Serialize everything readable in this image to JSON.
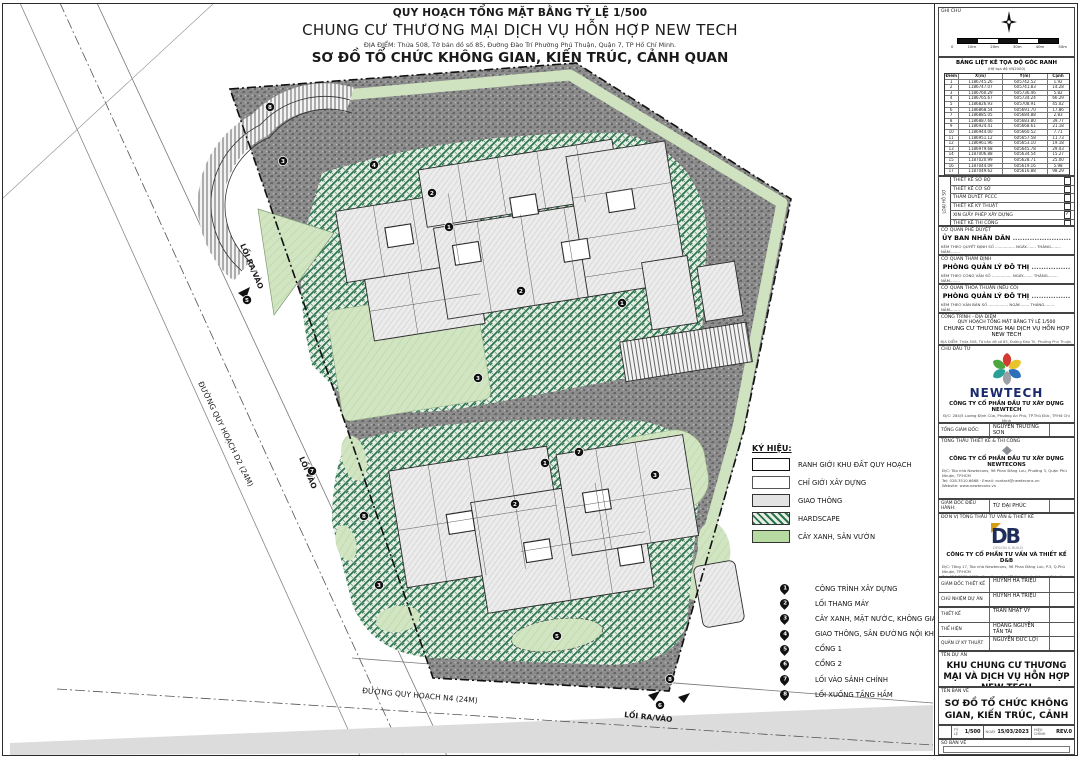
{
  "title_block": {
    "line1": "QUY HOẠCH TỔNG MẶT BẰNG TỶ LỆ 1/500",
    "line2": "CHUNG CƯ THƯƠNG MẠI DỊCH VỤ HỖN HỢP NEW TECH",
    "line3": "ĐỊA ĐIỂM: Thửa 508, Tờ bản đồ số 85, Đường Đào Trí Phường Phú Thuận, Quận 7, TP Hồ Chí Minh.",
    "line4": "SƠ ĐỒ TỔ CHỨC KHÔNG GIAN, KIẾN TRÚC, CẢNH QUAN"
  },
  "plan": {
    "road_d2": "ĐƯỜNG QUY HOẠCH D2 (24M)",
    "road_n4": "ĐƯỜNG QUY HOẠCH N4 (24M)",
    "exit_left": "LỐI RA/VÀO",
    "entry_left": "LỐI VÀO",
    "exit_bottom": "LỐI RA/VÀO",
    "markers": [
      {
        "n": "8",
        "x": 268,
        "y": 104
      },
      {
        "n": "3",
        "x": 281,
        "y": 158
      },
      {
        "n": "4",
        "x": 372,
        "y": 162
      },
      {
        "n": "2",
        "x": 430,
        "y": 190
      },
      {
        "n": "1",
        "x": 447,
        "y": 224
      },
      {
        "n": "2",
        "x": 519,
        "y": 288
      },
      {
        "n": "3",
        "x": 476,
        "y": 375
      },
      {
        "n": "7",
        "x": 577,
        "y": 449
      },
      {
        "n": "1",
        "x": 543,
        "y": 460
      },
      {
        "n": "3",
        "x": 653,
        "y": 472
      },
      {
        "n": "2",
        "x": 513,
        "y": 501
      },
      {
        "n": "8",
        "x": 362,
        "y": 513
      },
      {
        "n": "3",
        "x": 377,
        "y": 582
      },
      {
        "n": "5",
        "x": 555,
        "y": 633
      },
      {
        "n": "8",
        "x": 668,
        "y": 676
      },
      {
        "n": "6",
        "x": 658,
        "y": 702
      },
      {
        "n": "5",
        "x": 245,
        "y": 297
      },
      {
        "n": "7",
        "x": 310,
        "y": 468
      },
      {
        "n": "1",
        "x": 620,
        "y": 300
      }
    ]
  },
  "legend": {
    "title": "KÝ HIỆU:",
    "items": [
      {
        "label": "RANH GIỚI KHU ĐẤT QUY HOẠCH"
      },
      {
        "label": "CHỈ GIỚI XÂY DỰNG"
      },
      {
        "label": "GIAO THÔNG"
      },
      {
        "label": "HARDSCAPE"
      },
      {
        "label": "CÂY XANH, SÂN VƯỜN"
      }
    ]
  },
  "callouts": [
    {
      "num": "1",
      "label": "CÔNG TRÌNH XÂY DỰNG"
    },
    {
      "num": "2",
      "label": "LỐI THANG MÁY"
    },
    {
      "num": "3",
      "label": "CÂY XANH, MẶT NƯỚC, KHÔNG GIAN MỞ"
    },
    {
      "num": "4",
      "label": "GIAO THÔNG, SÂN ĐƯỜNG NỘI KHU"
    },
    {
      "num": "5",
      "label": "CỔNG 1"
    },
    {
      "num": "6",
      "label": "CỔNG 2"
    },
    {
      "num": "7",
      "label": "LỐI VÀO SẢNH CHÍNH"
    },
    {
      "num": "8",
      "label": "LỐI XUỐNG TẦNG HẦM"
    }
  ],
  "right_panel": {
    "ghi_chu": "GHI CHÚ",
    "scale_labels": [
      "0",
      "10m",
      "20m",
      "30m",
      "40m",
      "50m"
    ],
    "coord_table": {
      "title": "BẢNG LIỆT KÊ TỌA ĐỘ GÓC RANH",
      "subtitle": "(Hệ tọa độ VN2000)",
      "col_point": "Điểm",
      "col_x": "X(m)",
      "col_y": "Y(m)",
      "col_edge": "Cạnh",
      "rows": [
        [
          "1",
          "1186745.26",
          "605742.52",
          "1.92"
        ],
        [
          "2",
          "1186747.07",
          "605741.83",
          "14.28"
        ],
        [
          "3",
          "1186760.29",
          "605736.46",
          "5.82"
        ],
        [
          "4",
          "1186765.67",
          "605734.24",
          "66.29"
        ],
        [
          "5",
          "1186826.93",
          "605708.91",
          "45.02"
        ],
        [
          "6",
          "1186868.54",
          "605691.70",
          "17.86"
        ],
        [
          "7",
          "1186885.05",
          "605684.88",
          "2.83"
        ],
        [
          "8",
          "1186887.66",
          "605683.80",
          "39.77"
        ],
        [
          "9",
          "1186924.41",
          "605668.61",
          "21.18"
        ],
        [
          "10",
          "1186944.00",
          "605660.52",
          "7.71"
        ],
        [
          "11",
          "1186951.12",
          "605657.58",
          "11.73"
        ],
        [
          "12",
          "1186961.96",
          "605653.10",
          "19.18"
        ],
        [
          "13",
          "1186979.68",
          "605645.78",
          "29.43"
        ],
        [
          "14",
          "1187006.88",
          "605634.54",
          "15.27"
        ],
        [
          "15",
          "1187020.99",
          "605628.71",
          "25.00"
        ],
        [
          "16",
          "1187044.09",
          "605619.16",
          "5.98"
        ],
        [
          "17",
          "1187049.62",
          "605616.88",
          "98.29"
        ],
        [
          "18",
          "1187140.45",
          "605579.33",
          "–"
        ]
      ]
    },
    "phases": {
      "side_label": "LOẠI HỒ SƠ",
      "items": [
        {
          "label": "THIẾT KẾ SƠ BỘ",
          "check": ""
        },
        {
          "label": "THIẾT KẾ CƠ SỞ",
          "check": ""
        },
        {
          "label": "THẨM DUYỆT PCCC",
          "check": ""
        },
        {
          "label": "THIẾT KẾ KỸ THUẬT",
          "check": ""
        },
        {
          "label": "XIN GIẤY PHÉP XÂY DỰNG",
          "check": "✓"
        },
        {
          "label": "THIẾT KẾ THI CÔNG",
          "check": ""
        }
      ]
    },
    "approvals": [
      {
        "header": "CƠ QUAN PHÊ DUYỆT",
        "agency": "ỦY BAN NHÂN DÂN",
        "dots": "........................",
        "note": "KÈM THEO QUYẾT ĐỊNH SỐ ................  NGÀY........  THÁNG........  NĂM........"
      },
      {
        "header": "CƠ QUAN THẨM ĐỊNH",
        "agency": "PHÒNG QUẢN LÝ ĐÔ THỊ",
        "dots": "................",
        "note": "KÈM THEO CÔNG VĂN SỐ ................  NGÀY........  THÁNG........  NĂM........"
      },
      {
        "header": "CƠ QUAN THỎA THUẬN (NẾU CÓ)",
        "agency": "PHÒNG QUẢN LÝ ĐÔ THỊ",
        "dots": "................",
        "note": "KÈM THEO VĂN BẢN SỐ ................  NGÀY........  THÁNG........  NĂM........"
      }
    ],
    "cong_trinh": {
      "header": "CÔNG TRÌNH - ĐỊA ĐIỂM",
      "line1": "QUY HOẠCH TỔNG MẶT BẰNG TỶ LỆ 1/500",
      "line2": "CHUNG CƯ THƯƠNG MẠI DỊCH VỤ HỖN HỢP NEW TECH",
      "line3": "ĐỊA ĐIỂM: Thửa 508, Tờ bản đồ số 85, Đường Đào Trí, Phường Phú Thuận, Quận 7, TP Hồ Chí Minh."
    },
    "chu_dau_tu": {
      "header": "CHỦ ĐẦU TƯ",
      "brand": "NEWTECH",
      "company": "CÔNG TY CỔ PHẦN ĐẦU TƯ XÂY DỰNG NEWTECH",
      "addr1": "Đ/C: 284/5 Lương Định Của, Phường An Phú, TP.Thủ Đức, TP.Hồ Chí Minh",
      "addr2": "Tel: 028.3744.1666",
      "ceo_label": "TỔNG GIÁM ĐỐC:",
      "ceo_name": "NGUYỄN TRƯỜNG SƠN"
    },
    "tong_thau": {
      "header": "TỔNG THẦU THIẾT KẾ & THI CÔNG",
      "company": "CÔNG TY CỔ PHẦN ĐẦU TƯ XÂY DỰNG NEWTECONS",
      "dc": "Đ/C:  Tòa nhà Newtecons, 96 Phan Đăng Lưu, Phường 3, Quận Phú Nhuận, TP.HCM",
      "tel": "Tel:  028.3510.6668",
      "email": "Email:  contact@newtecons.vn",
      "web": "Website:  www.newtecons.vn",
      "exec_label": "GIÁM ĐỐC ĐIỀU HÀNH:",
      "exec_name": "TỪ ĐẠI PHÚC"
    },
    "don_vi": {
      "header": "ĐƠN VỊ TỔNG THẦU TƯ VẤN & THIẾT KẾ",
      "logo_text": "DB",
      "tagline": "DESIGN & BUILD",
      "company": "CÔNG TY CỔ PHẦN TƯ VẤN VÀ THIẾT KẾ D&B",
      "dc": "Đ/C:  Tầng 17, Tòa nhà Newtecons, 96 Phan Đăng Lưu, P.3, Q.Phú Nhuận, TP.HCM",
      "tel": "Tel:  028.3535.6655",
      "email": "Email:  contact@dbdesignbuild.vn",
      "web": "Website:  www.dbdesignbuild.vn"
    },
    "staff": [
      {
        "role": "GIÁM ĐỐC THIẾT KẾ",
        "name": "HUỲNH HÀ TRIỆU"
      },
      {
        "role": "CHỦ NHIỆM DỰ ÁN",
        "name": "HUỲNH HÀ TRIỆU"
      },
      {
        "role": "THIẾT KẾ",
        "name": "TRẦN NHẬT VỸ"
      },
      {
        "role": "THỂ HIỆN",
        "name": "HOÀNG NGUYỄN TẤN TÀI"
      },
      {
        "role": "QUẢN LÝ KỸ THUẬT",
        "name": "NGUYỄN ĐỨC LỢI"
      }
    ],
    "ten_du_an_label": "TÊN DỰ ÁN",
    "ten_du_an": "KHU CHUNG CƯ THƯƠNG MẠI VÀ DỊCH VỤ HỖN HỢP NEW TECH",
    "ten_ban_ve_label": "TÊN BẢN VẼ",
    "ten_ban_ve": "SƠ ĐỒ TỔ CHỨC KHÔNG GIAN, KIẾN TRÚC, CẢNH QUAN",
    "meta": {
      "ty_le_label": "TỶ LỆ",
      "ty_le": "1/500",
      "ngay_label": "NGÀY",
      "ngay": "15/03/2023",
      "hieu_chinh_label": "HIỆU CHỈNH",
      "hieu_chinh": "REV.0"
    },
    "so_ban_ve_label": "SỐ BẢN VẼ"
  },
  "colors": {
    "road": "#8c8c8c",
    "hardscape_green": "#2c7350",
    "lawn": "#d2e5c2",
    "navy": "#1b2a6b",
    "db_navy": "#1e2d5a",
    "db_gold": "#d4a017"
  }
}
